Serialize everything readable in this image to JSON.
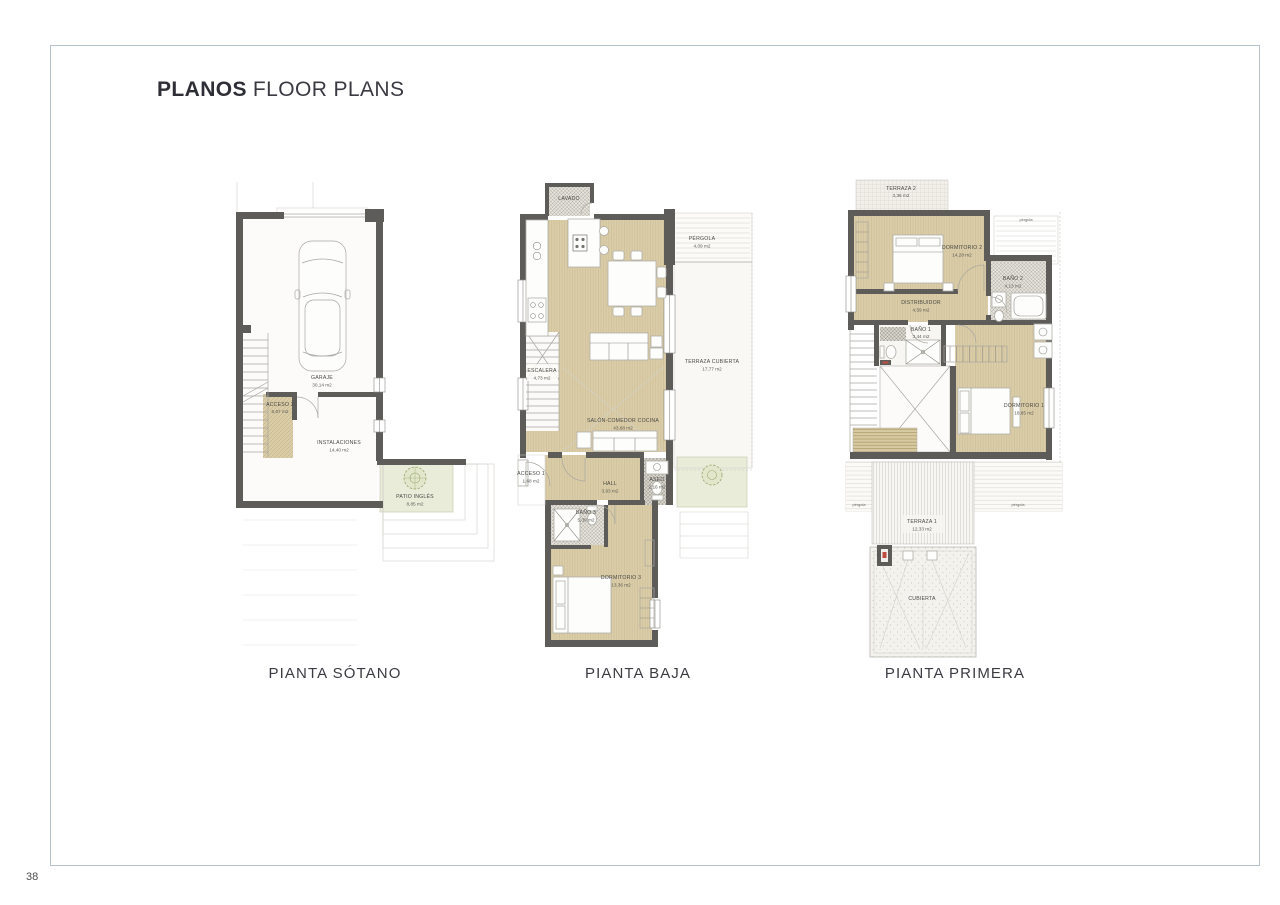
{
  "page": {
    "title_primary": "PLANOS",
    "title_secondary": "FLOOR PLANS",
    "page_number": "38"
  },
  "colors": {
    "frame_border": "#b6c2ca",
    "wall": "#5d5c59",
    "floor_beige": "#d9cda6",
    "patio_green": "#e9ecd9",
    "label_text": "#4b4a46"
  },
  "plans": {
    "sotano": {
      "caption": "PIANTA SÓTANO",
      "rooms": {
        "garaje": {
          "name": "GARAJE",
          "area": "30,14 m2"
        },
        "acceso2": {
          "name": "ACCESO 2",
          "area": "6,67 m2"
        },
        "instalaciones": {
          "name": "INSTALACIONES",
          "area": "14,40 m2"
        },
        "patio_ingles": {
          "name": "PATIO INGLÉS",
          "area": "8,85 m2"
        }
      }
    },
    "baja": {
      "caption": "PIANTA BAJA",
      "rooms": {
        "lavado": {
          "name": "LAVADO",
          "area": ""
        },
        "pergola": {
          "name": "PÉRGOLA",
          "area": "4,09 m2"
        },
        "terraza_cubierta": {
          "name": "TERRAZA CUBIERTA",
          "area": "17,77 m2"
        },
        "escalera": {
          "name": "ESCALERA",
          "area": "4,73 m2"
        },
        "salon": {
          "name": "SALÓN-COMEDOR COCINA",
          "area": "43,68 m2"
        },
        "acceso1": {
          "name": "ACCESO 1",
          "area": "1,68 m2"
        },
        "hall": {
          "name": "HALL",
          "area": "3,93 m2"
        },
        "aseo": {
          "name": "ASEO",
          "area": "2,16 m2"
        },
        "bano3": {
          "name": "BAÑO 3",
          "area": "5,39 m2"
        },
        "dormitorio3": {
          "name": "DORMITORIO 3",
          "area": "13,36 m2"
        }
      }
    },
    "primera": {
      "caption": "PIANTA PRIMERA",
      "rooms": {
        "terraza2": {
          "name": "TERRAZA 2",
          "area": "3,36 m2"
        },
        "pergola_top": {
          "name": "pérgola",
          "area": ""
        },
        "dormitorio2": {
          "name": "DORMITORIO 2",
          "area": "14,28 m2"
        },
        "bano2": {
          "name": "BAÑO 2",
          "area": "4,13 m2"
        },
        "distribuidor": {
          "name": "DISTRIBUIDOR",
          "area": "4,59 m2"
        },
        "bano1": {
          "name": "BAÑO 1",
          "area": "3,44 m2"
        },
        "dormitorio1": {
          "name": "DORMITORIO 1",
          "area": "18,85 m2"
        },
        "terraza1": {
          "name": "TERRAZA 1",
          "area": "12,33 m2"
        },
        "pergola_left": {
          "name": "pérgola",
          "area": ""
        },
        "pergola_right": {
          "name": "pérgola",
          "area": ""
        },
        "cubierta": {
          "name": "CUBIERTA",
          "area": ""
        }
      }
    }
  }
}
